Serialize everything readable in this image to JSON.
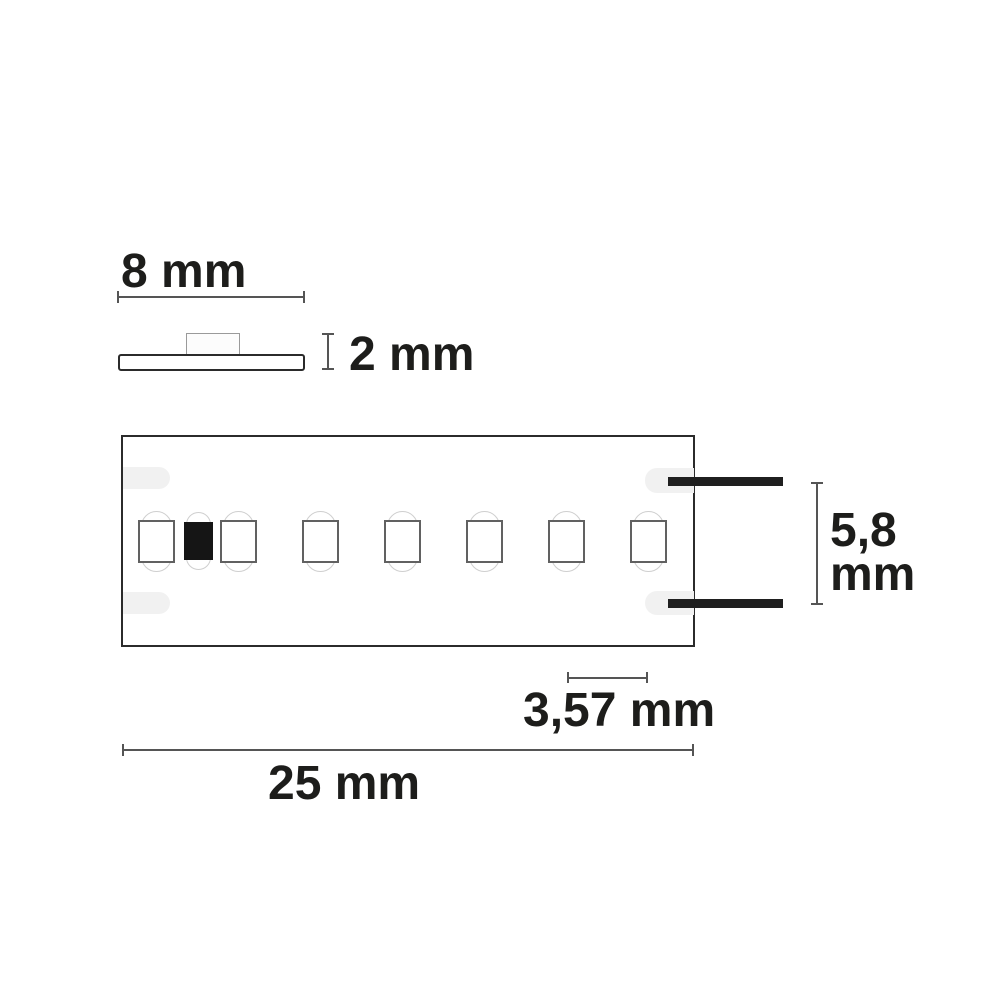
{
  "diagram": {
    "type": "technical dimension drawing",
    "subject": "LED flex strip, side profile and top view"
  },
  "dim_labels": {
    "width8": "8 mm",
    "height2": "2 mm",
    "width58_line1": "5,8",
    "width58_line2": "mm",
    "pitch357": "3,57 mm",
    "length25": "25 mm"
  },
  "side_view": {
    "parts": [
      "base-strip",
      "led-chip-profile"
    ],
    "strip_width_label": "8 mm",
    "strip_height_label": "2 mm"
  },
  "top_view": {
    "pcb_width_label": "5,8 mm",
    "led_pitch_label": "3,57 mm",
    "segment_length_label": "25 mm",
    "wire_count": 2,
    "solder_pad_count": 4,
    "components": [
      {
        "type": "led",
        "x": 138
      },
      {
        "type": "resistor",
        "x": 184
      },
      {
        "type": "led",
        "x": 220
      },
      {
        "type": "led",
        "x": 302
      },
      {
        "type": "led",
        "x": 384
      },
      {
        "type": "led",
        "x": 466
      },
      {
        "type": "led",
        "x": 548
      },
      {
        "type": "led",
        "x": 630
      }
    ]
  },
  "colors": {
    "line": "#555555",
    "text": "#1d1d1b",
    "outline": "#2b2b2b",
    "led_border": "#616161",
    "glow": "#cfcfcf",
    "pad": "#f1f1f1",
    "resistor": "#151515",
    "wire": "#1f1f1f",
    "background": "#ffffff"
  }
}
